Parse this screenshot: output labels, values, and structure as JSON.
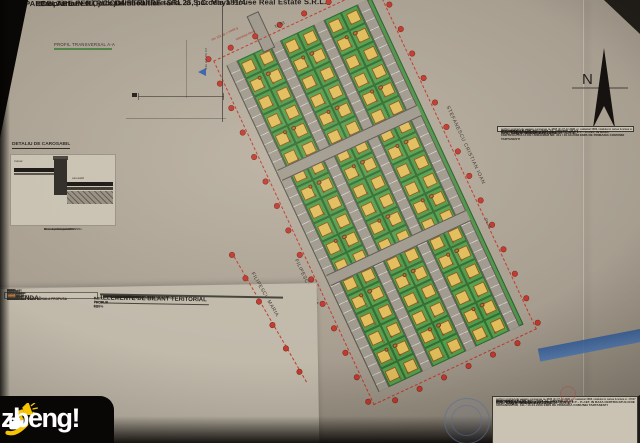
{
  "title_bar": {
    "bullet_left": "• PARCELARE PENTRU CONSTRUIRE –",
    "middle": "com. Tartasesti, jud. Dambovita – tarla 25, parcela 181/4 –",
    "right": "Proprietari: S.C. Copel Imobiliare SRL si S.C. Maya House Real Estate S.R.L."
  },
  "annotations": {
    "profile_label": "PROFIL TRANSVERSAL A-A",
    "zona_verde": "zona verde"
  },
  "detail": {
    "title": "DETALIU DE CAROSABIL",
    "label_trotuar": "trotuar",
    "label_carosabil": "carosabil",
    "layers": [
      "4 cm strat de uzura BA 16",
      "5 cm strat de legatura BAD 25",
      "20 cm balast stabilizat",
      "30 cm fundatie de balast",
      "bordura prefabricata 20 x 25 cm"
    ]
  },
  "map": {
    "north_label": "N",
    "owner_right": "STEFANESCU CRISTIAN IOAN",
    "owner_left": "FILIPESCU MARIA",
    "road_top": "De 71",
    "road_right": "De 46",
    "red_note_1": "limita intravilan",
    "red_note_2": "S teren = 35 321 mp",
    "grid": {
      "roads": [
        4,
        52,
        100,
        148
      ],
      "road_h": 12,
      "strips": [
        16,
        64,
        112
      ],
      "row_h": 18,
      "lot_w": 20,
      "lots_per_row": 18,
      "cross_roads": [
        116,
        232
      ]
    },
    "boundary": {
      "margin": 16,
      "spacing": 27,
      "length": 360,
      "width": 160
    },
    "ext_boundary_dots": 6
  },
  "proprietari": {
    "title": "PROPRIETARI",
    "owner1_name": "S.C. Copel Imobiliare SRL",
    "owner1_area": "Suprafata: 14 775 mp ; tarla 25, parcela 181/4",
    "owner1_note": "conform contract de vanzare-cumparare nr. 3394 din 07.12.2005, nr. cadastral 3894, intabulat in cartea funciara nr. 17637",
    "owner2_name": "S.C. Maya House Real Estate S.R.L.",
    "owner2_area": "Suprafata: 14 775 mp ; tarla 25, parcela 181/4",
    "owner2_note": "conform contract de vanzare-cumparare nr. 3595 din 07.12.2005, nr. cadastral 3895, intabulat in cartea funciara nr. 17637",
    "puz_note": "P.U.Z. IN VEDEREA PARCELARII PENTRU LOCUINTE P – P+1ET, IN BAZA CERTIFICATULUI DE URBANISM NR. 311 / 16.04.2008 EMIS DE PRIMARIA COMUNEI TARTASESTI"
  },
  "legend": {
    "title": "LEGENDA:",
    "limits_heading": "LIMITE",
    "limit_items": [
      "LIMITA ZONEI STUDIATE IN P.U.Z.",
      "LIMITA TERITORIULUI INTRAVILAN EXISTENT",
      "LIMITA TERITORIULUI INTRAVILAN PROPUS"
    ],
    "zoning_heading": "ZONIFICARE FUNCTIONALA PROPUSA",
    "items": [
      {
        "color": "#e2bd5c",
        "label": "ZONA LOCUINTE INDIVIDUALE P – P+1E"
      },
      {
        "color": "#d9a441",
        "label": "ZONA ANEXE GOSPODARESTI"
      },
      {
        "color": "#5da04f",
        "label": "ZONA SPATII VERZI AMENAJATE"
      },
      {
        "color": "#2e7d4f",
        "label": "PLANTATII DE ALINIAMENT"
      },
      {
        "color": "#4fa3a0",
        "label": "ZONA GOSPODARIE COMUNALA - EDILITARA"
      },
      {
        "color": "#3f6fb0",
        "label": "RETELE TEHNICO-EDILITARE"
      },
      {
        "color": "#b6423a",
        "label": "CIRCULATII CAROSABILE PROPUSE"
      },
      {
        "color": "#9a948a",
        "label": "CIRCULATII PIETONALE - TROTUARE"
      },
      {
        "color": "#cfc8ba",
        "label": "PARCAJE AUTO PUBLICE"
      },
      {
        "color": "#b9743c",
        "label": "POMI FRUCTIFERI EXISTENTI"
      }
    ]
  },
  "bilant": {
    "title": "ELEMENTE DE BILANT TERITORIAL",
    "col_label": "SUPRAFATA TEREN",
    "col_existent": "EXISTENT (mp)",
    "col_propus": "PROPUS (mp)",
    "rows": [
      {
        "label": "SUPRAFATA TOTALA TEREN – ZONA STUDIATA P.U.Z.",
        "e": "35 321,00",
        "p": "35 321,00"
      },
      {
        "label": "CATEG. DE FOLOSINTA: LIVADA – EXTRAVILAN",
        "e": "35 321,00",
        "p": "—"
      },
      {
        "label": "CIRCULATII – STRAZI",
        "e": "—",
        "p": "5 162,30"
      },
      {
        "label": "ALEI PIETONALE / TROTUARE",
        "e": "—",
        "p": "1 341,45"
      },
      {
        "label": "PARCAJE AUTO – PUBLICE",
        "e": "—",
        "p": "173,40"
      },
      {
        "label": "PLATFORME GOSPODARESTI",
        "e": "—",
        "p": "52,20"
      },
      {
        "label": "SUPRAFATA CONSTRUITA LOCUINTE (96 LOTURI)",
        "e": "—",
        "p": "3 506,30"
      },
      {
        "label": "ANEXE GOSPODARESTI (96 POZITII)",
        "e": "—",
        "p": "948,20"
      },
      {
        "label": "SPATII VERZI AMENAJATE",
        "e": "—",
        "p": "4 032,00"
      },
      {
        "label": "TEREN LIBER IN CADRUL LOTURILOR",
        "e": "—",
        "p": "20 105,15"
      },
      {
        "label": "TOTAL",
        "e": "35 321,00",
        "p": "35 321,00"
      }
    ],
    "footer_pot": "P.O.T. PROPUS 32,9%",
    "footer_cut": "C.U.T. PROPUS 0,9"
  },
  "watermark": {
    "text": "zbeng!"
  }
}
